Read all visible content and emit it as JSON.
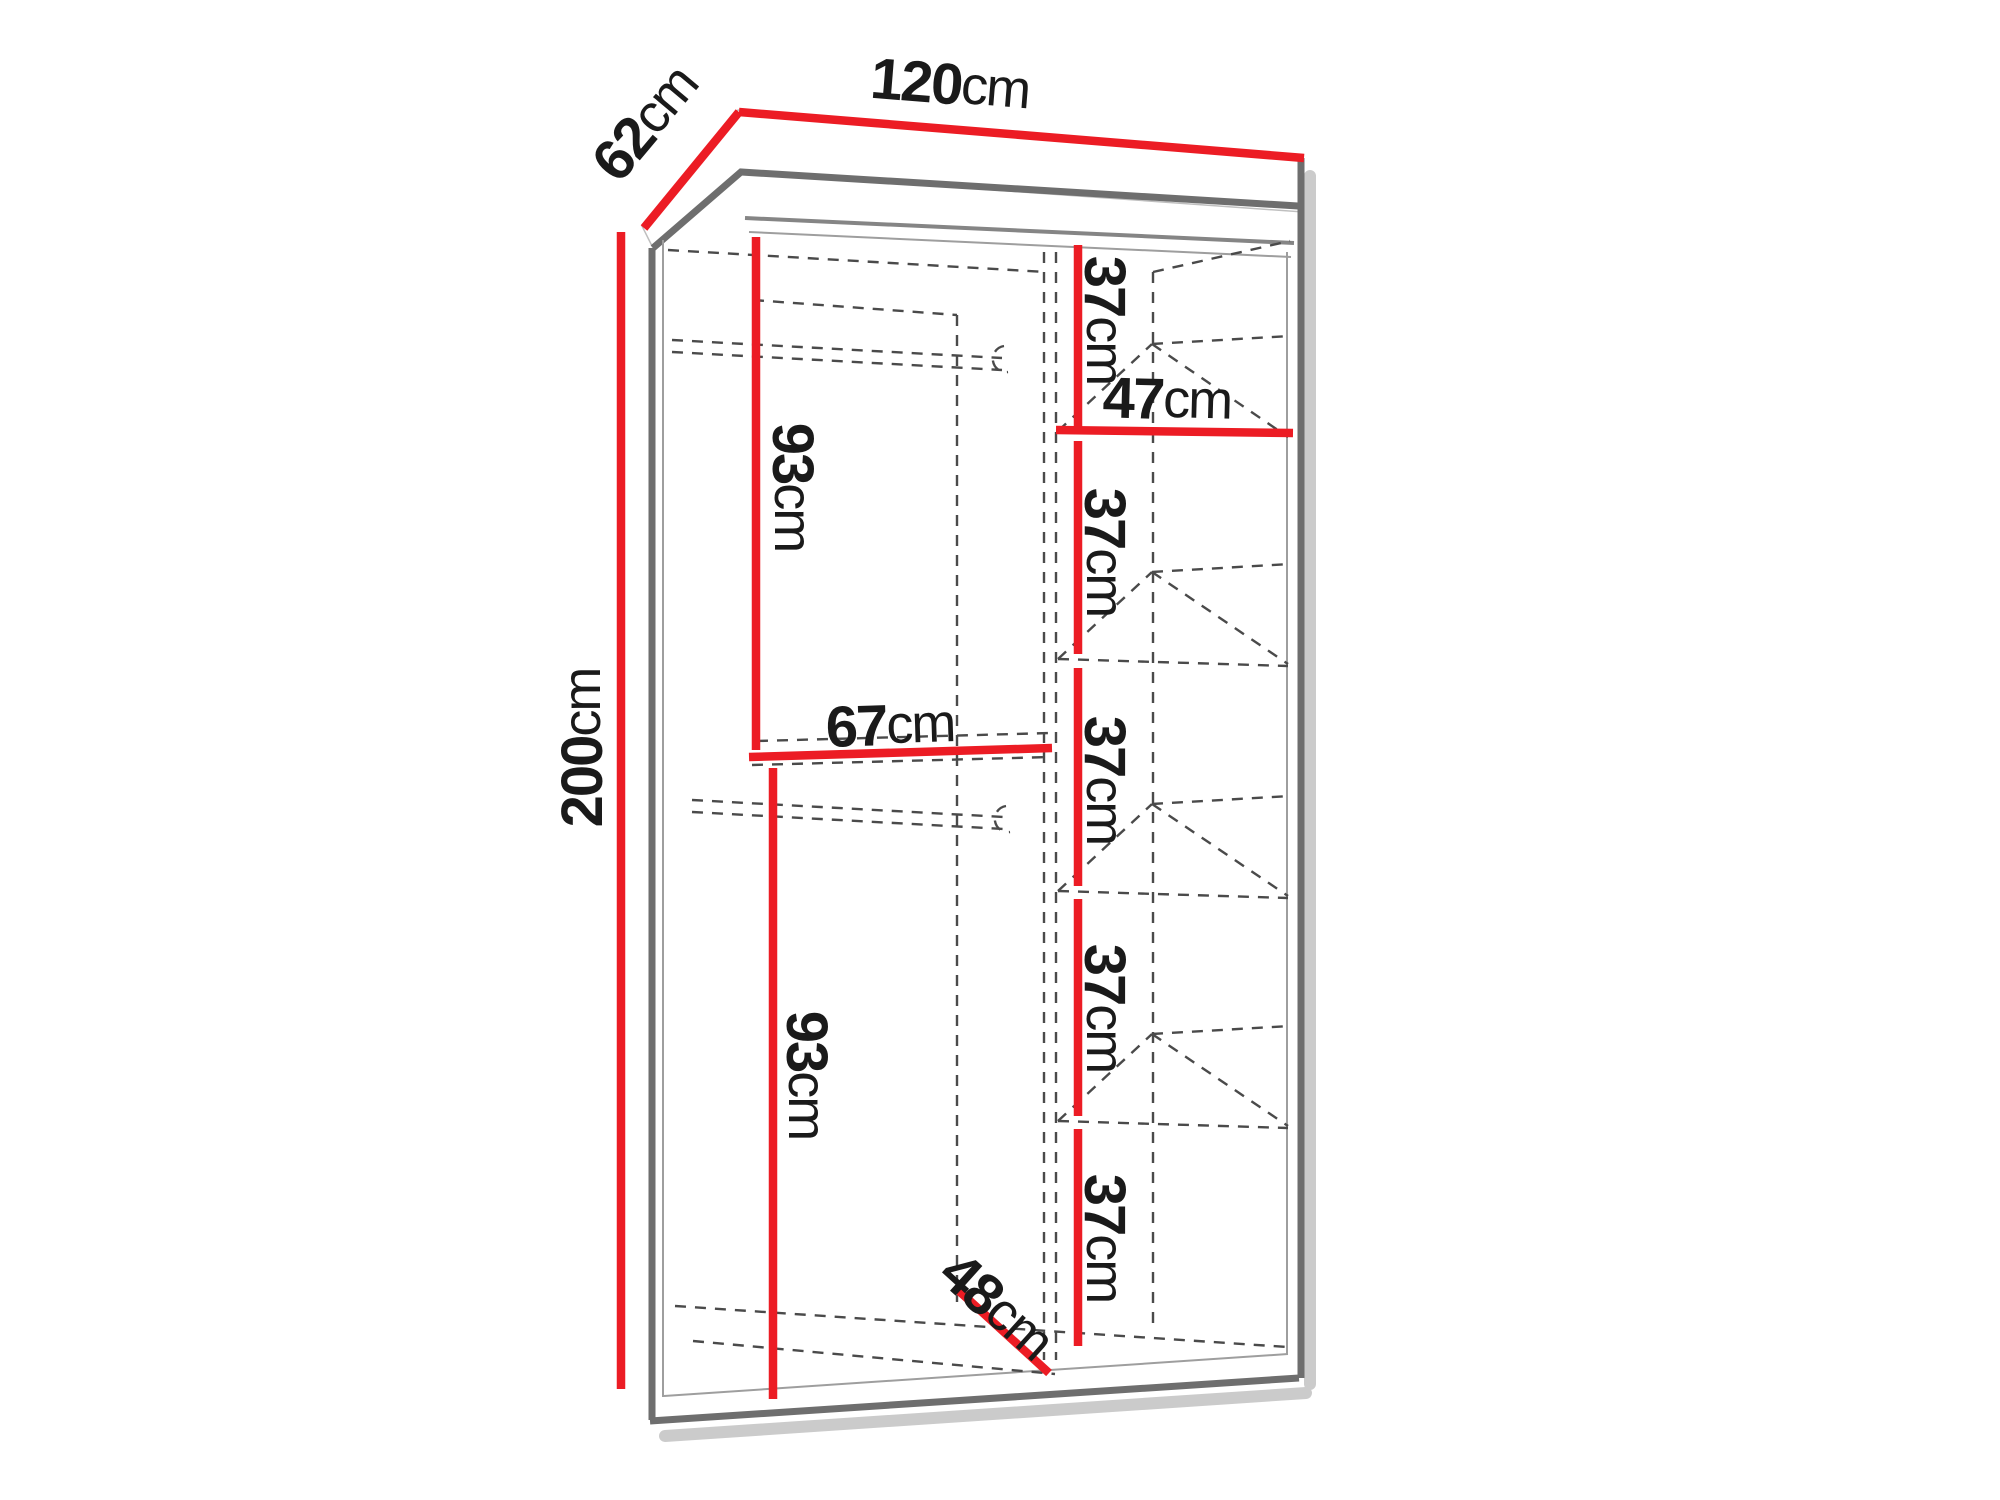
{
  "colors": {
    "dimension_line": "#ec1c24",
    "outline_dark": "#6e6e6e",
    "outline_light": "#9e9e9e",
    "dashed_line": "#4a4a4a",
    "label_text": "#1a1a1a",
    "shadow": "#c2c2c2",
    "background": "#ffffff"
  },
  "dimensions": {
    "width": {
      "value": "120",
      "unit": "cm"
    },
    "depth": {
      "value": "62",
      "unit": "cm"
    },
    "height": {
      "value": "200",
      "unit": "cm"
    },
    "upper_left_section_height": {
      "value": "93",
      "unit": "cm"
    },
    "lower_left_section_height": {
      "value": "93",
      "unit": "cm"
    },
    "left_section_width": {
      "value": "67",
      "unit": "cm"
    },
    "right_section_width": {
      "value": "47",
      "unit": "cm"
    },
    "bottom_depth": {
      "value": "48",
      "unit": "cm"
    },
    "shelf_sections": [
      {
        "value": "37",
        "unit": "cm"
      },
      {
        "value": "37",
        "unit": "cm"
      },
      {
        "value": "37",
        "unit": "cm"
      },
      {
        "value": "37",
        "unit": "cm"
      },
      {
        "value": "37",
        "unit": "cm"
      }
    ]
  }
}
